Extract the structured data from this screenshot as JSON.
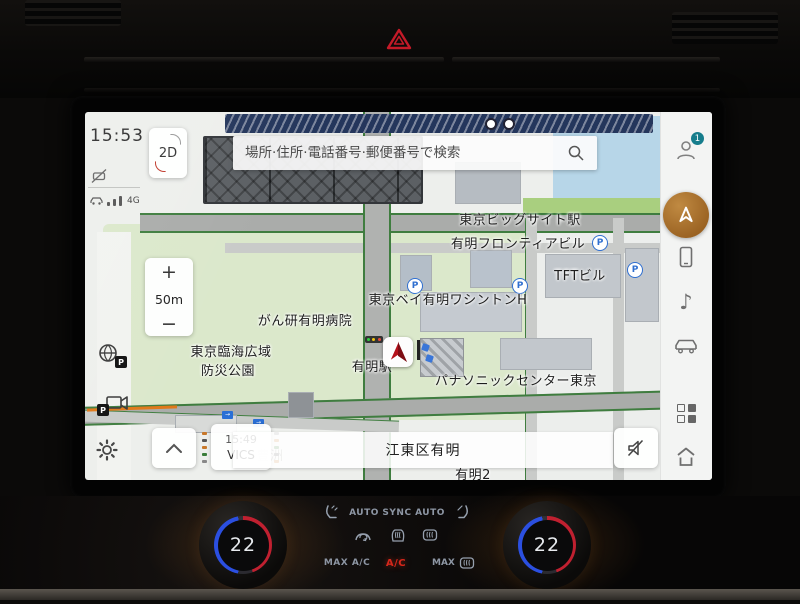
{
  "screen": {
    "status": {
      "time": "15:53",
      "view_mode": "2D",
      "network": "4G"
    },
    "search": {
      "placeholder": "場所·住所·電話番号·郵便番号で検索"
    },
    "zoom": {
      "in": "+",
      "scale": "50m",
      "out": "−"
    },
    "sidebar": {
      "profile_badge": "1",
      "music_glyph": "♪"
    },
    "map": {
      "parking_glyph": "P",
      "labels": [
        {
          "id": "tokyo-big-sight-station",
          "text": "東京ビッグサイト駅"
        },
        {
          "id": "ariake-frontier-building",
          "text": "有明フロンティアビル"
        },
        {
          "id": "tft-building",
          "text": "TFTビル"
        },
        {
          "id": "tokyo-bay-ariake-washington-hotel",
          "text": "東京ベイ有明ワシントンH"
        },
        {
          "id": "ganken-ariake-hospital",
          "text": "がん研有明病院"
        },
        {
          "id": "rinkai-park-line1",
          "text": "東京臨海広域"
        },
        {
          "id": "rinkai-park-line2",
          "text": "防災公園"
        },
        {
          "id": "ariake-station",
          "text": "有明駅"
        },
        {
          "id": "panasonic-center-tokyo",
          "text": "パナソニックセンター東京"
        },
        {
          "id": "toyosu",
          "text": "豊洲"
        },
        {
          "id": "ariake-2",
          "text": "有明2"
        }
      ]
    },
    "bottom_bar": {
      "vics_time": "15:49",
      "vics_label": "VICS",
      "location": "江東区有明"
    }
  },
  "climate": {
    "driver_temp": "22",
    "passenger_temp": "22",
    "auto_driver": "AUTO",
    "sync": "SYNC",
    "auto_passenger": "AUTO",
    "max_ac": "MAX A/C",
    "ac": "A/C",
    "max_defrost": "MAX"
  },
  "colors": {
    "nav_accent": "#a9712d",
    "profile_badge": "#167d8c",
    "ac_active": "#d6271b",
    "map_park": "#dbe8cb",
    "map_water": "#b7d6e8",
    "rail_line": "#24365c",
    "car_arrow": "#b5121b"
  }
}
